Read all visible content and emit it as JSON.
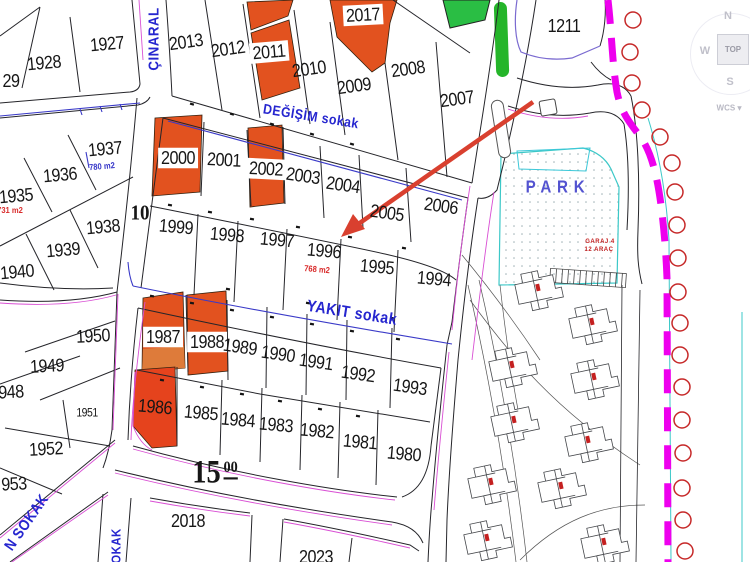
{
  "labels": {
    "p29": "29",
    "p1928": "1928",
    "p1927": "1927",
    "p2013": "2013",
    "p2012": "2012",
    "p2011": "2011",
    "p2017": "2017",
    "p2010": "2010",
    "p2009": "2009",
    "p2008": "2008",
    "p2007": "2007",
    "p1211": "1211",
    "p1937": "1937",
    "p1936": "1936",
    "p1935": "1935",
    "p1938": "1938",
    "p1939": "1939",
    "p1940": "1940",
    "p2000": "2000",
    "p2001": "2001",
    "p2002": "2002",
    "p2003": "2003",
    "p2004": "2004",
    "p2005": "2005",
    "p2006": "2006",
    "p1999": "1999",
    "p1998": "1998",
    "p1997": "1997",
    "p1996": "1996",
    "p1995": "1995",
    "p1994": "1994",
    "p1950": "1950",
    "p1949": "1949",
    "p948": "948",
    "p1951": "1951",
    "p1952": "1952",
    "p953": "953",
    "p1987": "1987",
    "p1988": "1988",
    "p1989": "1989",
    "p1990": "1990",
    "p1991": "1991",
    "p1992": "1992",
    "p1993": "1993",
    "p1986": "1986",
    "p1985": "1985",
    "p1984": "1984",
    "p1983": "1983",
    "p1982": "1982",
    "p1981": "1981",
    "p1980": "1980",
    "p2018": "2018",
    "p2023": "2023"
  },
  "areas": {
    "a768": "768 m2",
    "a780": "780 m2",
    "a731": "731 m2"
  },
  "streets": {
    "cinaral": "ÇINARAL",
    "degisim": "DEĞİŞİM sokak",
    "yakit": "YAKIT sokak",
    "n_sokak": "N SOKAK",
    "sokak": "SOKAK",
    "park": "PARK"
  },
  "dims": {
    "d10": "10",
    "d15": "15",
    "d15sup": "00"
  },
  "garage": {
    "line1": "GARAJ 4",
    "line2": "12 ARAÇ"
  },
  "viewcube": {
    "n": "N",
    "w": "W",
    "s": "S",
    "top": "TOP",
    "wcs": "WCS",
    "wcs_arrow": "▾"
  },
  "colors": {
    "parcel_highlight": "#e2521f",
    "parcel_highlight_red": "#e5431d",
    "parcel_highlight_light": "#de7b3a",
    "street_text": "#2626cf",
    "park_text": "#5353d0",
    "annotation_arrow": "#d9402f",
    "boundary_dashed": "#ee00ee",
    "tree_marker": "#c62828",
    "green_area": "#2abe44",
    "park_border": "#3cc8c8",
    "pink_edge": "#d94fd4",
    "area_red": "#d92b2b",
    "area_blue": "#3535c8"
  }
}
